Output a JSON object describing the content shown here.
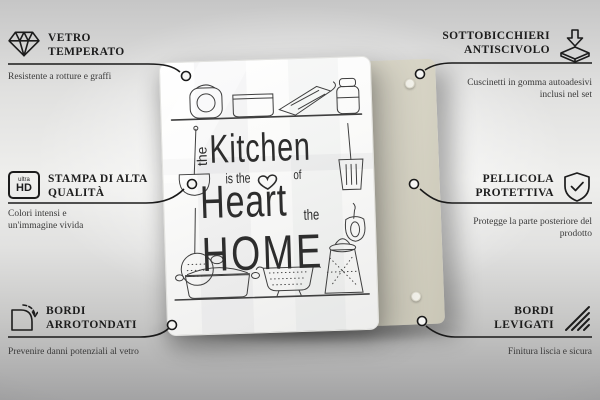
{
  "product": {
    "type": "glass kitchen board / coaster set",
    "board_color": "#fafaf9",
    "back_panel_color": "#d5d2c3",
    "print": {
      "word_the_1": "the",
      "kitchen": "Kitchen",
      "is_the": "is the",
      "of": "of",
      "heart": "Heart",
      "word_the_2": "the",
      "home": "HOME"
    }
  },
  "callouts": {
    "top_left": {
      "icon": "diamond",
      "title_line1": "VETRO",
      "title_line2": "TEMPERATO",
      "description": "Resistente a rotture e graffi"
    },
    "top_right": {
      "icon": "anti-slip-pad",
      "title_line1": "SOTTOBICCHIERI",
      "title_line2": "ANTISCIVOLO",
      "description": "Cuscinetti in gomma autoadesivi inclusi nel set"
    },
    "mid_left": {
      "icon": "ultra-hd-badge",
      "icon_label_top": "ultra",
      "icon_label_bottom": "HD",
      "title_line1": "STAMPA DI ALTA",
      "title_line2": "QUALITÀ",
      "description": "Colori intensi e un'immagine vivida"
    },
    "mid_right": {
      "icon": "shield-check",
      "title_line1": "PELLICOLA",
      "title_line2": "PROTETTIVA",
      "description": "Protegge la parte posteriore del prodotto"
    },
    "bottom_left": {
      "icon": "rounded-corner",
      "title_line1": "BORDI",
      "title_line2": "ARROTONDATI",
      "description": "Prevenire danni potenziali al vetro"
    },
    "bottom_right": {
      "icon": "polished-edge",
      "title_line1": "BORDI",
      "title_line2": "LEVIGATI",
      "description": "Finitura liscia e sicura"
    }
  }
}
